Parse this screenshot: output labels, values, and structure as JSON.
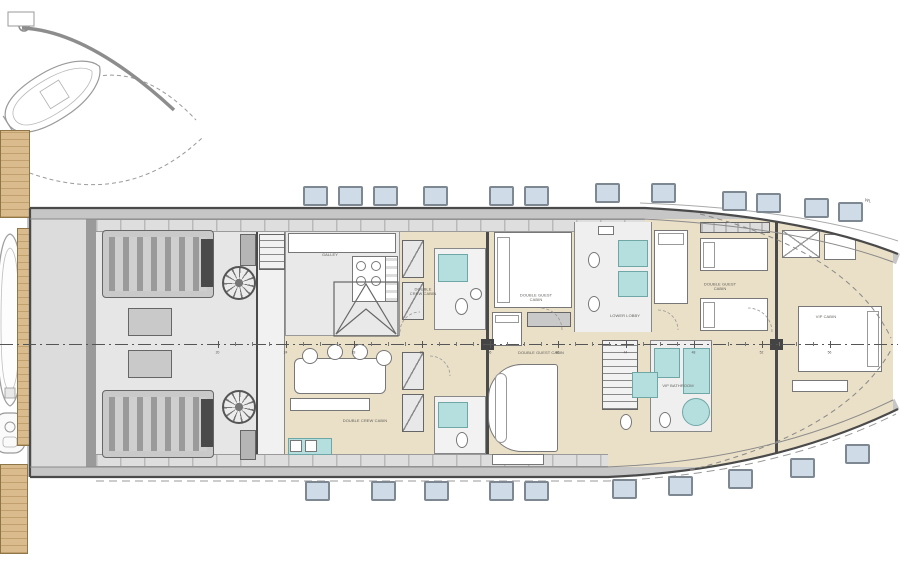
{
  "plan": {
    "labels": {
      "galley": "GALLEY",
      "crew_cabin_upper": "DOUBLE CREW CABIN",
      "crew_cabin_lower": "DOUBLE CREW CABIN",
      "guest_cabin_upper_left": "DOUBLE GUEST CABIN",
      "guest_cabin_upper_right": "DOUBLE GUEST CABIN",
      "guest_cabin_lower": "DOUBLE GUEST CABIN",
      "lower_lobby": "LOWER LOBBY",
      "vip_cabin": "VIP CABIN",
      "vip_bathroom": "VIP BATHROOM"
    },
    "annotations": {
      "waterline": "WL"
    },
    "frame_marks": [
      {
        "n": "20",
        "x": 218
      },
      {
        "n": "24",
        "x": 286
      },
      {
        "n": "28",
        "x": 354
      },
      {
        "n": "32",
        "x": 422
      },
      {
        "n": "36",
        "x": 490
      },
      {
        "n": "40",
        "x": 558
      },
      {
        "n": "44",
        "x": 626
      },
      {
        "n": "48",
        "x": 694
      },
      {
        "n": "52",
        "x": 762
      },
      {
        "n": "56",
        "x": 830
      }
    ],
    "portholes": {
      "top": [
        {
          "x": 303,
          "y": 186
        },
        {
          "x": 338,
          "y": 186
        },
        {
          "x": 373,
          "y": 186
        },
        {
          "x": 423,
          "y": 186
        },
        {
          "x": 489,
          "y": 186
        },
        {
          "x": 524,
          "y": 186
        },
        {
          "x": 595,
          "y": 183
        },
        {
          "x": 651,
          "y": 183
        },
        {
          "x": 722,
          "y": 191
        },
        {
          "x": 756,
          "y": 193
        },
        {
          "x": 804,
          "y": 198
        },
        {
          "x": 838,
          "y": 202
        }
      ],
      "bottom": [
        {
          "x": 305,
          "y": 481
        },
        {
          "x": 371,
          "y": 481
        },
        {
          "x": 424,
          "y": 481
        },
        {
          "x": 489,
          "y": 481
        },
        {
          "x": 524,
          "y": 481
        },
        {
          "x": 612,
          "y": 479
        },
        {
          "x": 668,
          "y": 476
        },
        {
          "x": 728,
          "y": 469
        },
        {
          "x": 790,
          "y": 458
        },
        {
          "x": 845,
          "y": 444
        }
      ]
    },
    "colors": {
      "cabin_floor": "#eadfc7",
      "technical_floor": "#e6e6e6",
      "shower": "#b5dede",
      "teak": "#d9bb8d",
      "porthole": "#cfdbe6",
      "hull_line": "#4a4a4a"
    }
  }
}
